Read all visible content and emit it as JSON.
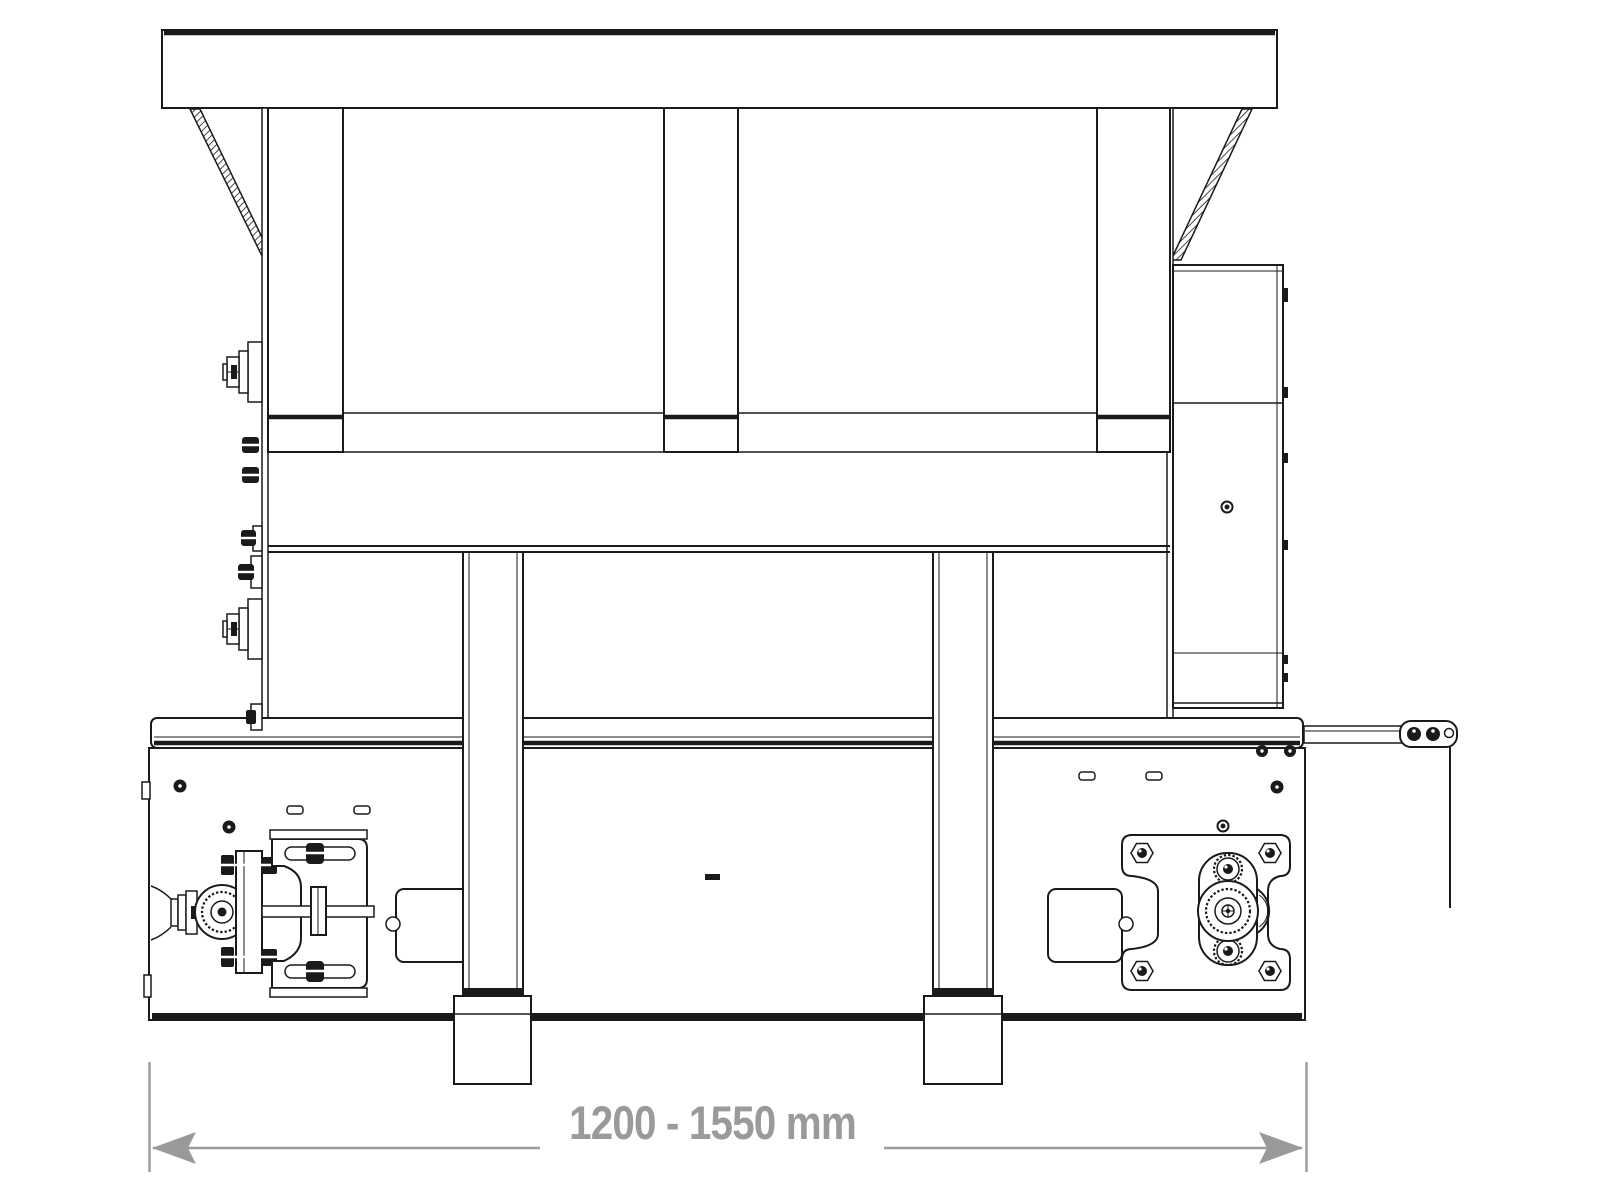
{
  "dimension": {
    "label": "1200 - 1550 mm",
    "min_mm": 1200,
    "max_mm": 1550,
    "unit": "mm"
  },
  "colors": {
    "line": "#1a1a1a",
    "dimension": "#9a9a9a",
    "background": "#ffffff"
  }
}
